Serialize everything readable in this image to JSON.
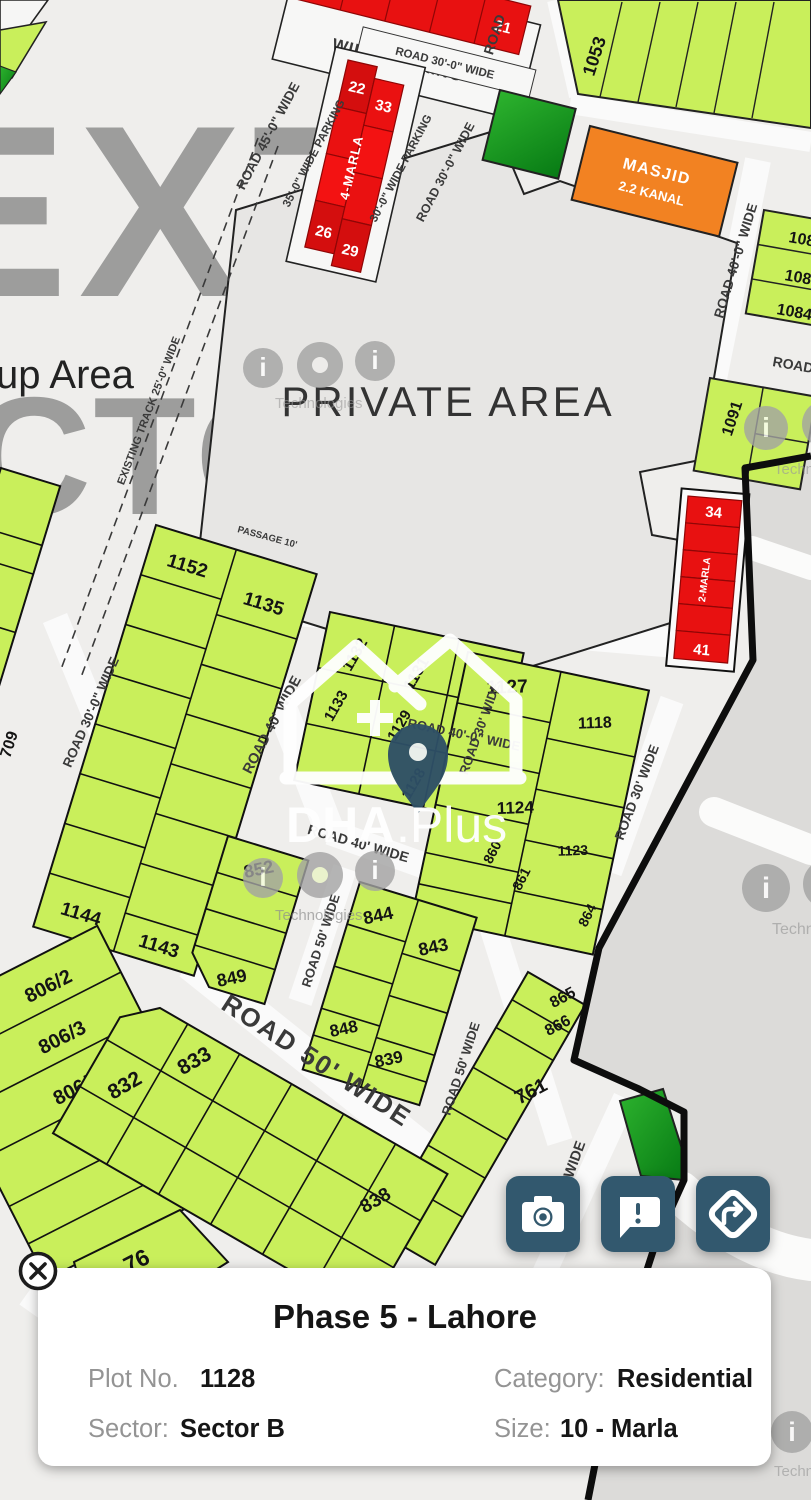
{
  "map": {
    "watermarks": {
      "next_sector_top": "EXT",
      "next_sector_bottom": "CTOR",
      "up_area": "up Area",
      "ioi": {
        "i1": "i",
        "o": "o",
        "i2": "i",
        "technologies": "Technologies"
      },
      "dha": "DHA",
      "plus": ".Plus"
    },
    "areas": {
      "private_area": "PRIVATE AREA",
      "masjid_line1": "MASJID",
      "masjid_line2": "2.2 KANAL"
    },
    "road_labels": {
      "wide_parking": "WIDE PARKING",
      "road_30_top": "ROAD 30'-0\" WIDE",
      "road_45": "ROAD 45'-0\" WIDE",
      "parking_35": "35'-0\" WIDE PARKING",
      "parking_30": "30'-0\" WIDE PARKING",
      "road_30_2": "ROAD 30'-0\" WIDE",
      "road_tr": "ROAD",
      "road_40_right": "ROAD 40'-0\" WIDE",
      "road_right_edge": "ROAD",
      "existing_track": "EXISTING TRACK 25'-0\" WIDE",
      "passage": "PASSAGE 10'",
      "road_40_below_private": "ROAD 40'-0\" WIDE",
      "road_30_left": "ROAD 30'-0\" WIDE",
      "road_40_center": "ROAD 40' WIDE",
      "road_30_mid": "ROAD 30' WIDE",
      "road_30_right": "ROAD 30' WIDE",
      "road_40_852": "ROAD 40' WIDE",
      "road_50_v1": "ROAD 50' WIDE",
      "road_50_big": "ROAD 50' WIDE",
      "road_50_v2": "ROAD 50' WIDE",
      "road_btm": "ROAD 30' WIDE"
    },
    "plot_labels": {
      "p21": "21",
      "p22": "22",
      "p33": "33",
      "p26": "26",
      "p29": "29",
      "marla4": "4-MARLA",
      "marla2": "2-MARLA",
      "p1053": "1053",
      "p1082": "1082",
      "p1083": "1083",
      "p1084": "1084",
      "p1091": "1091",
      "p34": "34",
      "p41": "41",
      "p1152": "1152",
      "p1135": "1135",
      "p1144": "1144",
      "p1143": "1143",
      "p709": "709",
      "p1132": "1132",
      "p1131": "1131",
      "p1130": "1130",
      "p1133": "1133",
      "p1129": "1129",
      "p1128": "1128",
      "p1127": "1127",
      "p1118": "1118",
      "p1124": "1124",
      "p1123": "1123",
      "p860": "860",
      "p861": "861",
      "p864": "864",
      "p852": "852",
      "p849": "849",
      "p844": "844",
      "p843": "843",
      "p848": "848",
      "p839": "839",
      "p865": "865",
      "p866": "866",
      "p761": "761",
      "p806_2": "806/2",
      "p806_3": "806/3",
      "p806_4": "806/4",
      "p76": "76",
      "p833": "833",
      "p832": "832",
      "p838": "838"
    }
  },
  "actions": {
    "camera": "camera",
    "report": "report",
    "directions": "directions"
  },
  "info_card": {
    "title": "Phase 5 - Lahore",
    "plot_no_label": "Plot No.",
    "plot_no_value": "1128",
    "category_label": "Category:",
    "category_value": "Residential",
    "sector_label": "Sector:",
    "sector_value": "Sector B",
    "size_label": "Size:",
    "size_value": "10 - Marla"
  },
  "colors": {
    "plot_green": "#c9ef5b",
    "plot_dark_green": "#14a120",
    "plot_red": "#e81111",
    "masjid_orange": "#f28222",
    "button_blue": "#33596e",
    "boundary": "#0d0d0d"
  }
}
